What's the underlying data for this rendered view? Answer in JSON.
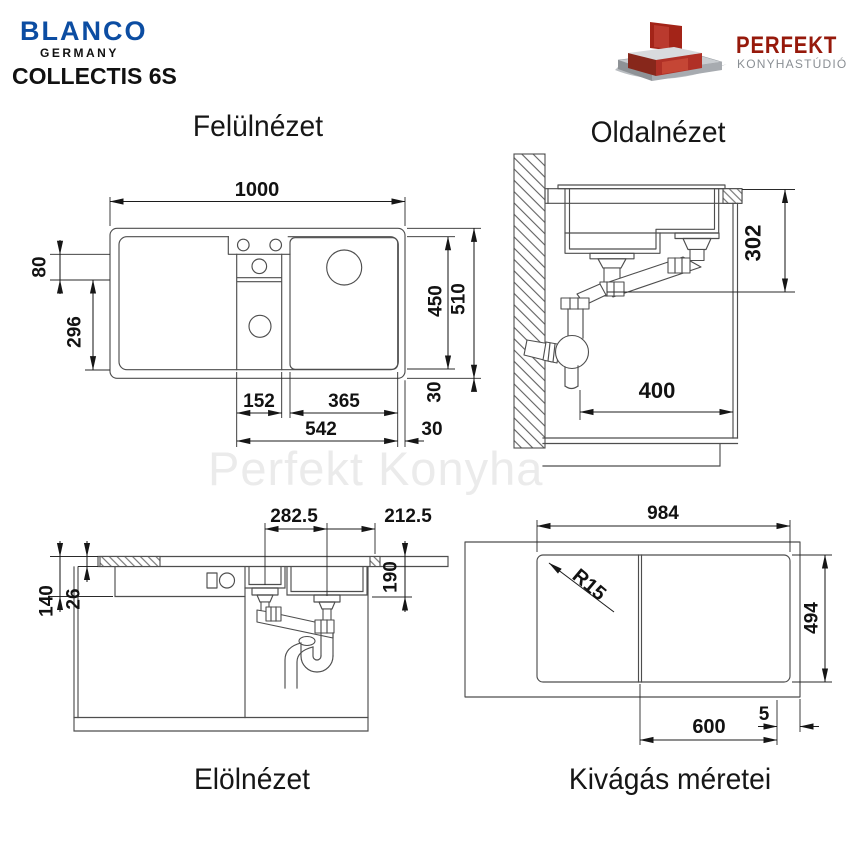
{
  "header": {
    "brand": "BLANCO",
    "brand_country": "GERMANY",
    "model": "COLLECTIS 6S",
    "dealer_name": "PERFEKT",
    "dealer_tagline": "KONYHASTÚDIÓ"
  },
  "watermark": "Perfekt Konyha",
  "views": {
    "top": {
      "title": "Felülnézet",
      "dims": {
        "overall_width": "1000",
        "ledge": "80",
        "drainboard": "296",
        "inner_depth": "450",
        "overall_depth": "510",
        "rim_v": "30",
        "middle_bowl": "152",
        "main_bowl": "365",
        "bowl_span": "542",
        "rim_h": "30"
      }
    },
    "side": {
      "title": "Oldalnézet",
      "dims": {
        "drain_height": "302",
        "clearance": "400"
      }
    },
    "front": {
      "title": "Elölnézet",
      "dims": {
        "drain_spacing": "282.5",
        "drain_to_edge": "212.5",
        "apron": "140",
        "rim": "26",
        "bowl_depth": "190"
      }
    },
    "cutout": {
      "title": "Kivágás méretei",
      "dims": {
        "width": "984",
        "height": "494",
        "radius": "R15",
        "cabinet": "600",
        "gap": "5"
      }
    }
  }
}
